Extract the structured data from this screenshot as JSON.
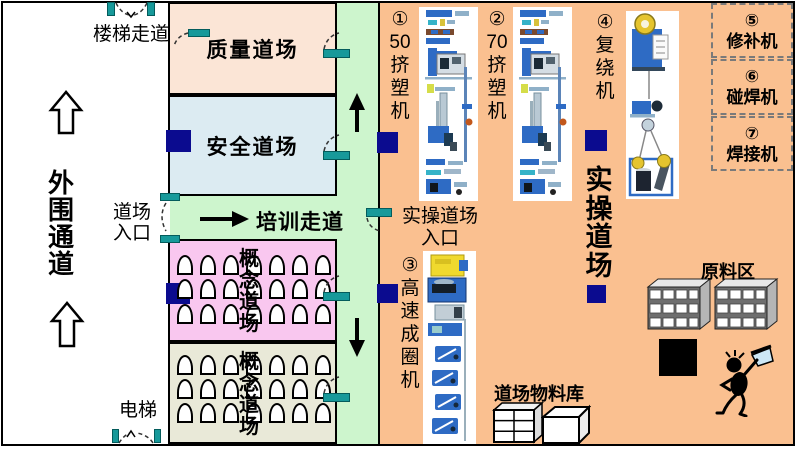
{
  "colors": {
    "zone_peach": "#fbe5d6",
    "zone_blue": "#dcebf2",
    "zone_green": "#cdf5cd",
    "zone_pink": "#f9c7ef",
    "zone_beige": "#e9e9d8",
    "zone_orange": "#fac090",
    "door_teal": "#17999a",
    "marker_navy": "#0b0b8f"
  },
  "outer_corridor": {
    "stair_walkway_label": "楼梯走道",
    "perimeter_label": "外\n围\n通\n道",
    "dojo_entrance_label": "道场\n入口",
    "elevator_label": "电梯"
  },
  "rooms": {
    "quality_label": "质量道场",
    "safety_label": "安全道场",
    "training_corridor_label": "培训走道",
    "concept_a_label": "概\n念\n道\n场",
    "concept_b_label": "概\n念\n道\n场",
    "practical_label": "实\n操\n道\n场",
    "practical_entrance_label": "实操道场\n入口"
  },
  "stations": {
    "extruder50_label": "①\n50\n挤\n塑\n机",
    "extruder70_label": "②\n70\n挤\n塑\n机",
    "coiler_label": "③\n高\n速\n成\n圈\n机",
    "rewinder_label": "④\n复\n绕\n机",
    "repair_label": "⑤\n修补机",
    "spot_welder_label": "⑥\n碰焊机",
    "welder_label": "⑦\n焊接机"
  },
  "storage": {
    "material_store_label": "道场物料库",
    "raw_material_label": "原料区"
  }
}
